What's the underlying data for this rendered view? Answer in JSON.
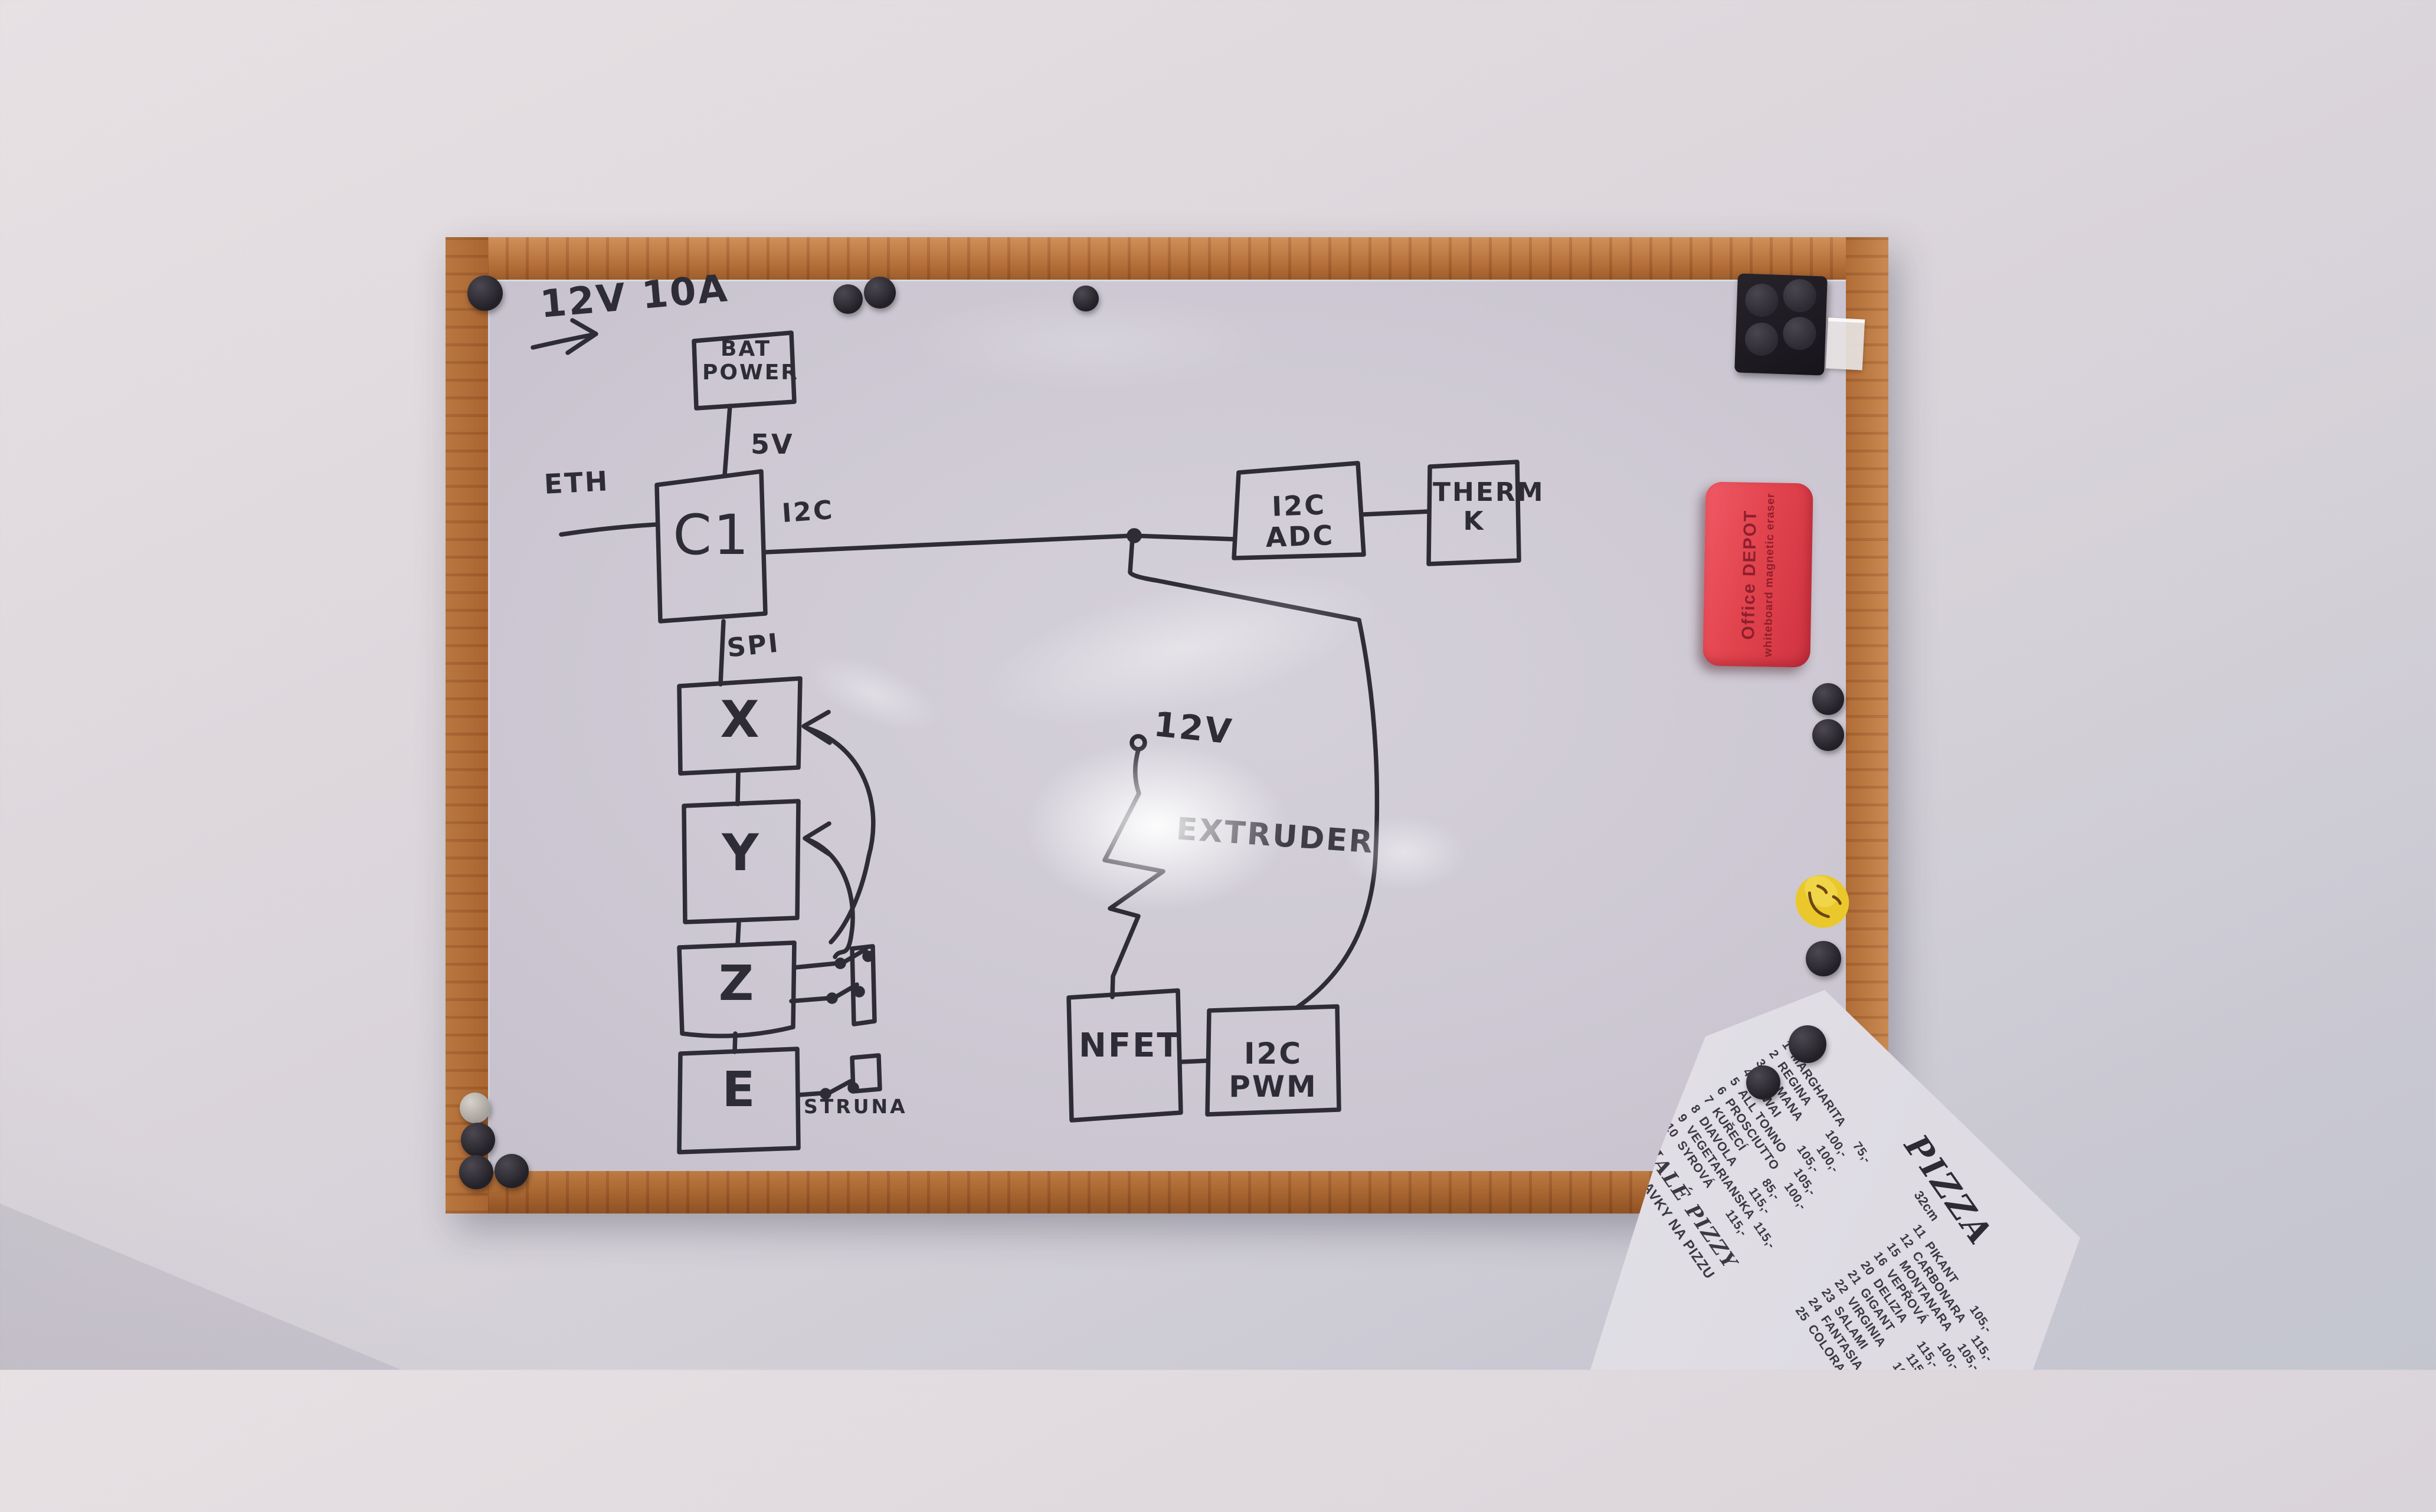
{
  "board": {
    "frame_color": "#b06c36",
    "surface_color": "#ccc7d2"
  },
  "diagram": {
    "power_label": "12V 10A",
    "nodes": {
      "bat": "BAT\nPOWER",
      "c1": "C1",
      "x": "X",
      "y": "Y",
      "z": "Z",
      "e": "E",
      "nfet": "NFET",
      "pwm": "I2C PWM",
      "adc": "I2C ADC",
      "therm": "THERM\nK"
    },
    "wires": {
      "v5": "5V",
      "eth": "ETH",
      "i2c": "I2C",
      "spi": "SPI",
      "v12": "12V"
    },
    "extruder_label": "EXTRUDER",
    "struna_label": "STRUNA",
    "ink_color": "#2e2d37"
  },
  "eraser": {
    "brand": "Office DEPOT",
    "subtitle": "whiteboard magnetic eraser",
    "color": "#e2444e"
  },
  "smiley_color": "#eac82b",
  "menu": {
    "title": "PIZZA",
    "size_note": "32cm",
    "rows": [
      "1  MARGHARITA      75,-",
      "2  REGINA         100,-",
      "3  ROMANA         100,-",
      "4  HAWAI          105,-",
      "5  ALL TONNO      105,-",
      "6  PROSCIUTTO     100,-",
      "7  KUŘECÍ          85,-",
      "8  DIAVOLA        115,-",
      "9  VEGETARIANSKA  115,-",
      "10  SYROVÁ        115,-",
      "11  PIKANT        105,-",
      "12  CARBONARA     115,-",
      "15  MONTANARA     105,-",
      "16  VEPŘOVÁ       100,-",
      "20  DELIZIA       115,-",
      "21  GIGANT        115,-",
      "22  VIRGINIA      105,-",
      "23  SALAMI        100,-",
      "24  FANTASIA      105,-",
      "25  COLORADO      100,-"
    ],
    "section1": "MALÉ PIZZY",
    "section2": "PŘIDAVKY NA PIZZU"
  }
}
